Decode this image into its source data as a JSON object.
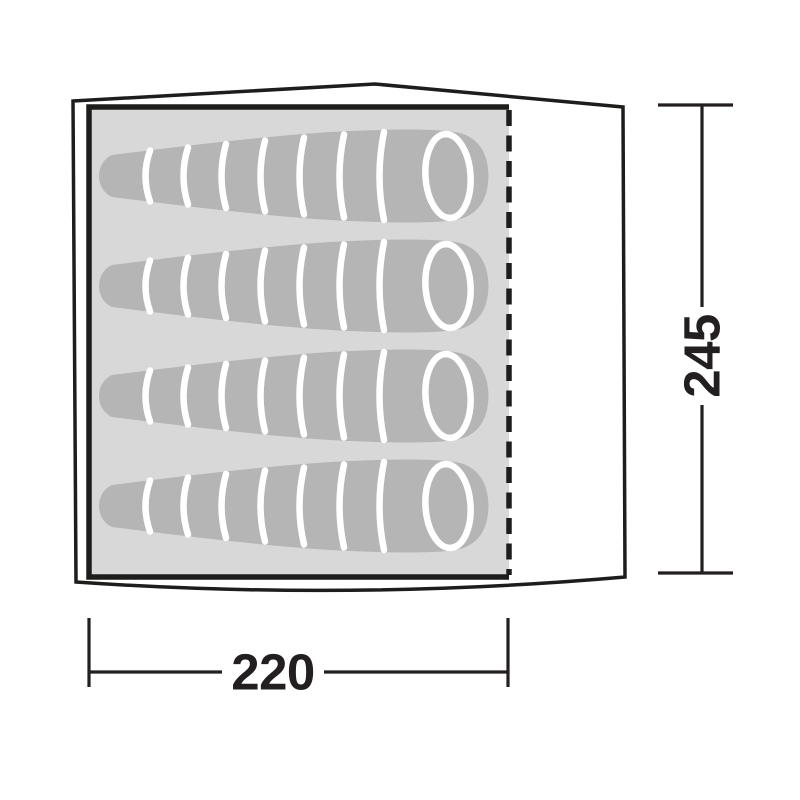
{
  "diagram": {
    "kind": "tent-floorplan",
    "width_dimension": {
      "label": "220"
    },
    "height_dimension": {
      "label": "245"
    },
    "sleeping_bags": {
      "count": 4,
      "icon": "sleeping-bag-icon"
    },
    "colors": {
      "outline": "#1d1d1b",
      "floor": "#d8d8d8",
      "sleeping_bag": "#b5b5b5",
      "stripe": "#ffffff",
      "label_text": "#231f20",
      "background": "#ffffff"
    }
  }
}
